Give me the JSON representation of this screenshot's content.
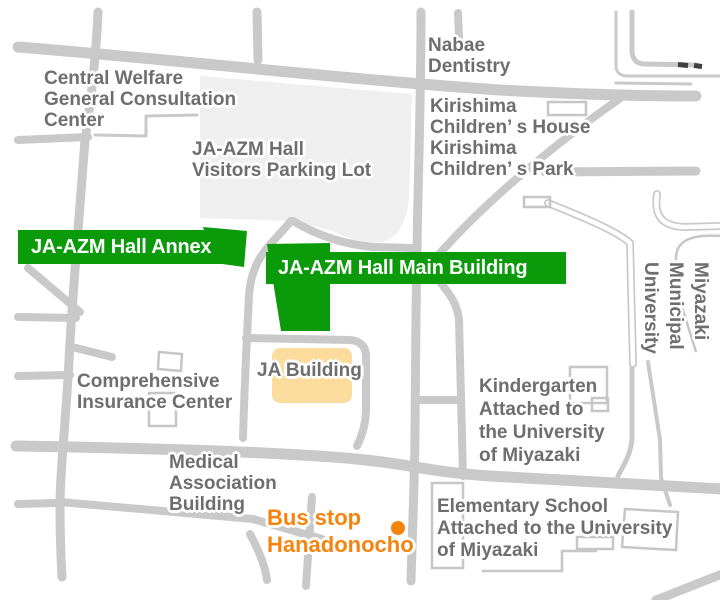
{
  "colors": {
    "background": "#ffffff",
    "road": "#c9c9c9",
    "parking": "#efefef",
    "building_outline": "#c6c6c6",
    "green": "#0a9a0a",
    "tan": "#fcdc9d",
    "label_gray": "#6e6e6e",
    "orange": "#f5840e",
    "dark_dash": "#3f3f3f"
  },
  "labels": {
    "central_welfare": {
      "text": "Central Welfare\nGeneral Consultation\nCenter"
    },
    "parking_lot": {
      "text": "JA-AZM Hall\nVisitors Parking Lot"
    },
    "nabae": {
      "text": "Nabae\nDentistry"
    },
    "kirishima": {
      "text": "Kirishima\nChildren’ s House\nKirishima\nChildren’ s Park"
    },
    "annex": {
      "text": "JA-AZM Hall Annex"
    },
    "main_building": {
      "text": "JA-AZM Hall Main Building"
    },
    "comprehensive": {
      "text": "Comprehensive\nInsurance Center"
    },
    "ja_building": {
      "text": "JA Building"
    },
    "kindergarten": {
      "text": "Kindergarten\nAttached to\nthe University\nof Miyazaki"
    },
    "miyazaki_university": {
      "text": "Miyazaki Municipal\nUniversity"
    },
    "medical": {
      "text": "Medical\nAssociation\nBuilding"
    },
    "bus_stop": {
      "text": "Bus stop\nHanadonocho"
    },
    "elementary": {
      "text": "Elementary School\nAttached to the University\nof Miyazaki"
    }
  },
  "markers": {
    "bus_stop_marker": {
      "shape": "circle",
      "color": "#f5840e"
    }
  }
}
